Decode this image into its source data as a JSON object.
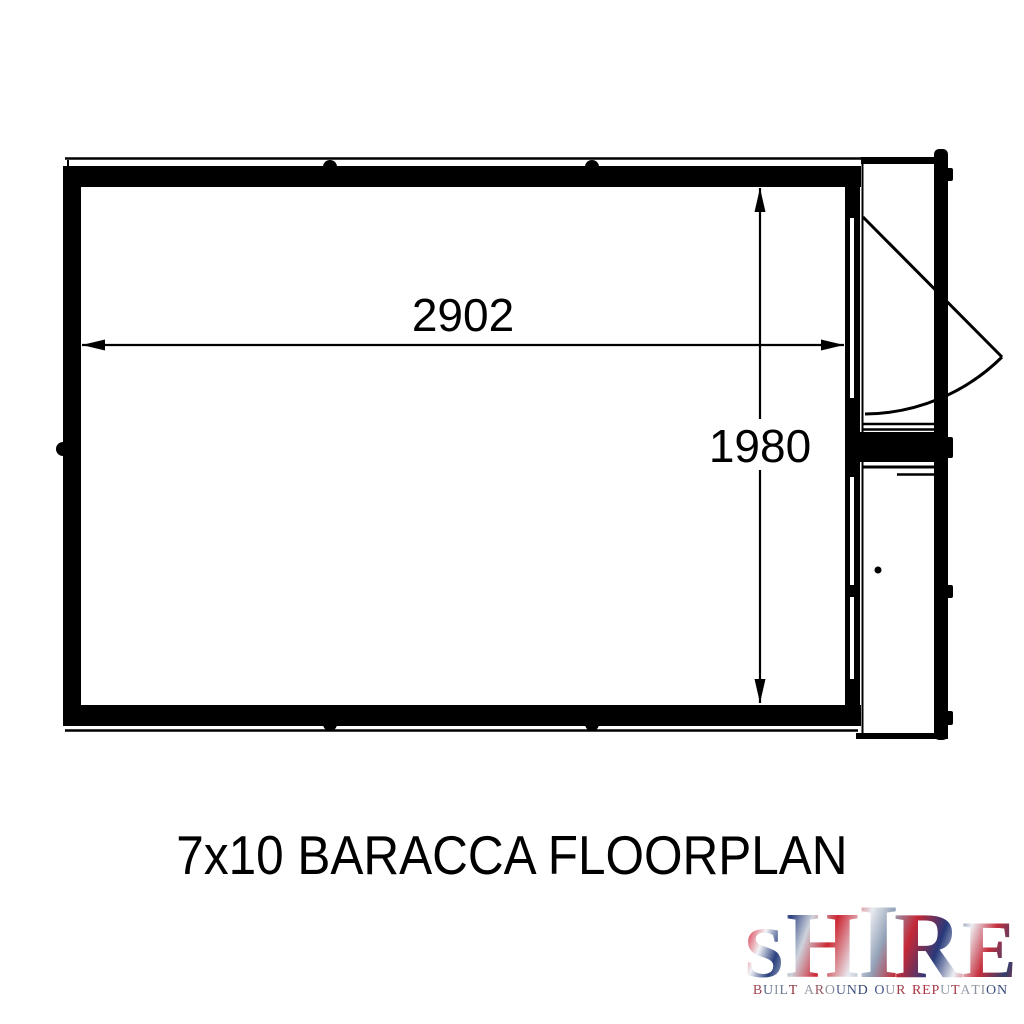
{
  "floorplan": {
    "title": "7x10 BARACCA FLOORPLAN",
    "model": "BARACCA",
    "size": "7x10",
    "width_label": "2902",
    "depth_label": "1980",
    "line_color": "#000000"
  },
  "logo": {
    "brand": "SHIRE",
    "letters": [
      "S",
      "H",
      "I",
      "R",
      "E"
    ],
    "tagline": "BUILT AROUND OUR REPUTATION",
    "tagline_letters": [
      {
        "ch": "B",
        "c": "#9c4550"
      },
      {
        "ch": "U",
        "c": "#5c6c8e"
      },
      {
        "ch": "I",
        "c": "#8d939e"
      },
      {
        "ch": "L",
        "c": "#6b7890"
      },
      {
        "ch": "T",
        "c": "#8e3540"
      },
      {
        "ch": " "
      },
      {
        "ch": "A",
        "c": "#959aa6"
      },
      {
        "ch": "R",
        "c": "#9a5560"
      },
      {
        "ch": "O",
        "c": "#8d939e"
      },
      {
        "ch": "U",
        "c": "#53648a"
      },
      {
        "ch": "N",
        "c": "#40527f"
      },
      {
        "ch": "D",
        "c": "#334672"
      },
      {
        "ch": " "
      },
      {
        "ch": "O",
        "c": "#44568a"
      },
      {
        "ch": "U",
        "c": "#8d939e"
      },
      {
        "ch": "R",
        "c": "#a04048"
      },
      {
        "ch": " "
      },
      {
        "ch": "R",
        "c": "#ab3440"
      },
      {
        "ch": "E",
        "c": "#ab3440"
      },
      {
        "ch": "P",
        "c": "#a63a46"
      },
      {
        "ch": "U",
        "c": "#98a0ac"
      },
      {
        "ch": "T",
        "c": "#a03a44"
      },
      {
        "ch": "A",
        "c": "#9aa0ab"
      },
      {
        "ch": "T",
        "c": "#8d939e"
      },
      {
        "ch": "I",
        "c": "#8d939e"
      },
      {
        "ch": "O",
        "c": "#3e5282"
      },
      {
        "ch": "N",
        "c": "#35497c"
      }
    ],
    "flag_colors": {
      "red": "#c62a35",
      "crimson": "#e04050",
      "navy": "#27397a",
      "silver": "#b9c2cd",
      "white": "#f2f4f7"
    }
  }
}
